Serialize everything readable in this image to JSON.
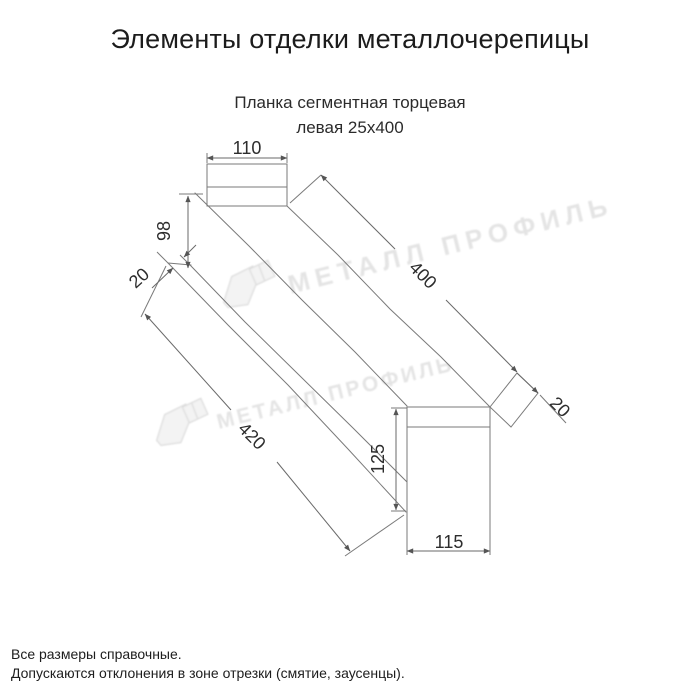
{
  "page": {
    "title": "Элементы отделки металлочерепицы",
    "footnotes": [
      "Все размеры справочные.",
      "Допускаются отклонения в зоне отрезки (смятие, заусенцы)."
    ]
  },
  "drawing": {
    "subtitle": {
      "line1": "Планка сегментная торцевая",
      "line2": "левая 25х400"
    },
    "dimensions": {
      "top_flange_width": "110",
      "left_end_height": "98",
      "left_hem": "20",
      "top_length": "400",
      "right_hem": "20",
      "bottom_length": "420",
      "right_end_height": "125",
      "right_end_width": "115"
    },
    "colors": {
      "line": "#7a7a7a",
      "dim_text": "#2d2d2d",
      "title_text": "#1c1c1c"
    }
  },
  "watermark": {
    "brand": "МЕТАЛЛ ПРОФИЛЬ",
    "color": "#e3e3e3"
  }
}
